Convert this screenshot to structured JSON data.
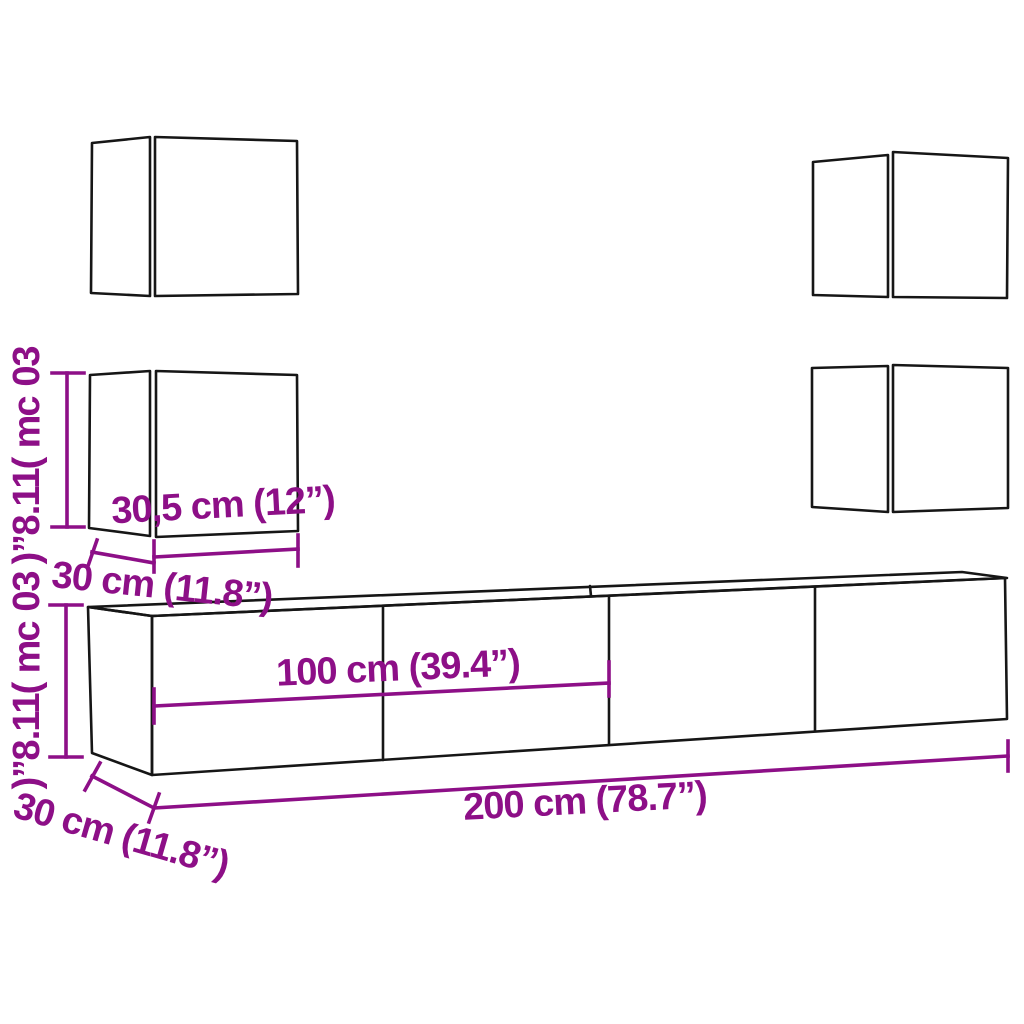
{
  "colors": {
    "dimension": "#8D0F87",
    "outline": "#161616",
    "background": "#FFFFFF"
  },
  "diagram_type": "furniture-dimension-diagram",
  "product": "wall-mounted tv cabinet set (4 square wall cabinets + tv bench)",
  "dimensions": {
    "wall_cabinet_height": "30 cm (11.8”)",
    "wall_cabinet_width": "30,5 cm (12”)",
    "wall_cabinet_depth": "30 cm (11.8”)",
    "stand_height": "30 cm (11.8”)",
    "stand_half_width": "100 cm (39.4”)",
    "stand_total_width": "200 cm (78.7”)",
    "stand_depth": "30 cm (11.8”)"
  }
}
